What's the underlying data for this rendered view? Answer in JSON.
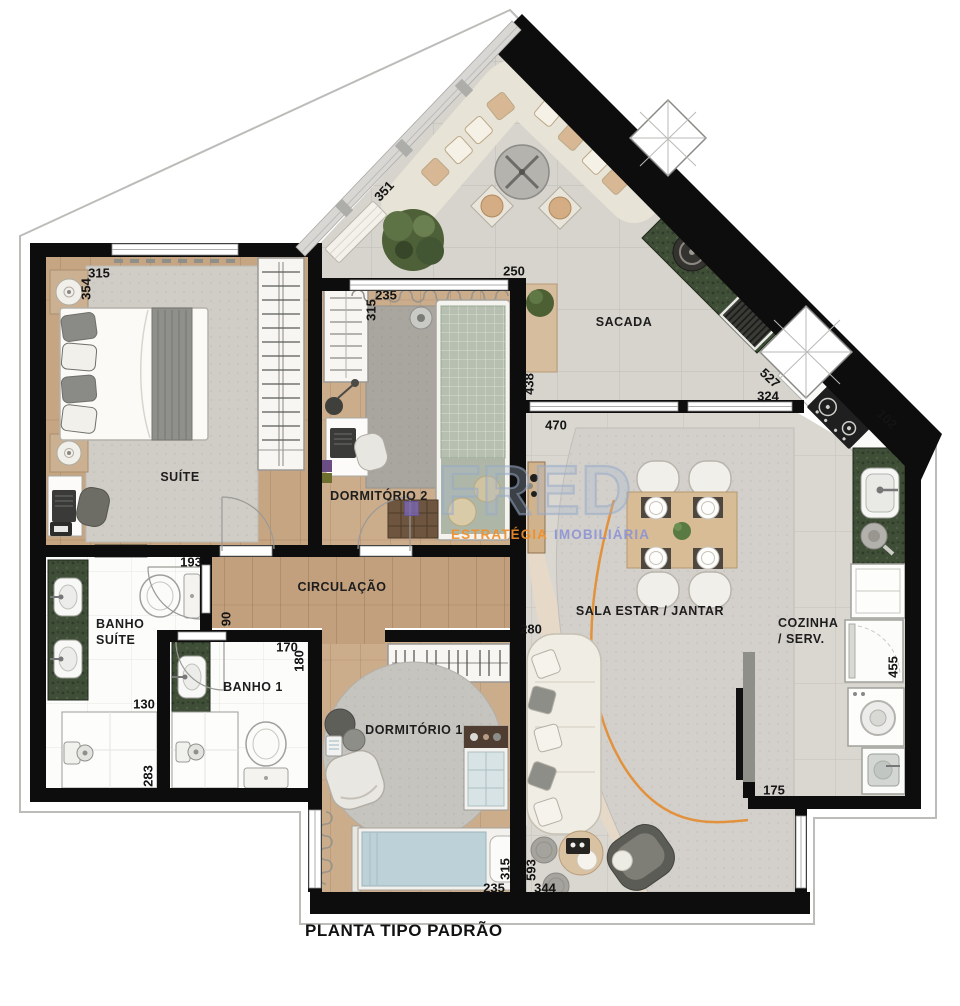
{
  "title": "PLANTA TIPO PADRÃO",
  "watermark": {
    "logo": "FRED",
    "tagline_word1": "ESTRATÉGIA",
    "tagline_word2": "IMOBILIÁRIA"
  },
  "rooms": {
    "suite": "SUÍTE",
    "dormitorio2": "DORMITÓRIO 2",
    "dormitorio1": "DORMITÓRIO 1",
    "sacada": "SACADA",
    "circulacao": "CIRCULAÇÃO",
    "banho_suite": "BANHO\nSUÍTE",
    "banho1": "BANHO 1",
    "sala": "SALA ESTAR / JANTAR",
    "cozinha": "COZINHA\n/ SERV."
  },
  "measurements": {
    "suite_width": "315",
    "suite_depth": "354",
    "dorm2_width": "235",
    "dorm2_depth": "315",
    "dorm2_window": "250",
    "sacada_edge_left": "351",
    "sacada_left_depth": "438",
    "sacada_edge_right": "527",
    "sacada_right_width": "324",
    "cooktop_edge": "102",
    "sala_window": "470",
    "sala_left": "280",
    "banho_suite_width": "193",
    "circulacao_width": "90",
    "banho1_width": "170",
    "banho1_depth": "180",
    "banho_suite_lower_width": "130",
    "shower_depth": "283",
    "dorm1_width": "235",
    "dorm1_depth": "315",
    "sala_depth": "593",
    "sala_bottom_width": "344",
    "cozinha_depth": "455",
    "cozinha_width": "175"
  },
  "colors": {
    "wall": "#0d0d0d",
    "wood_floor": "#c7a683",
    "tile_floor": "#d7d4ce",
    "counter_green": "#3f4e37",
    "rug_gray": "#d2cfca",
    "accent_orange": "#e2913c",
    "watermark_orange": "#f08e28",
    "watermark_violet": "#8c94d5"
  }
}
